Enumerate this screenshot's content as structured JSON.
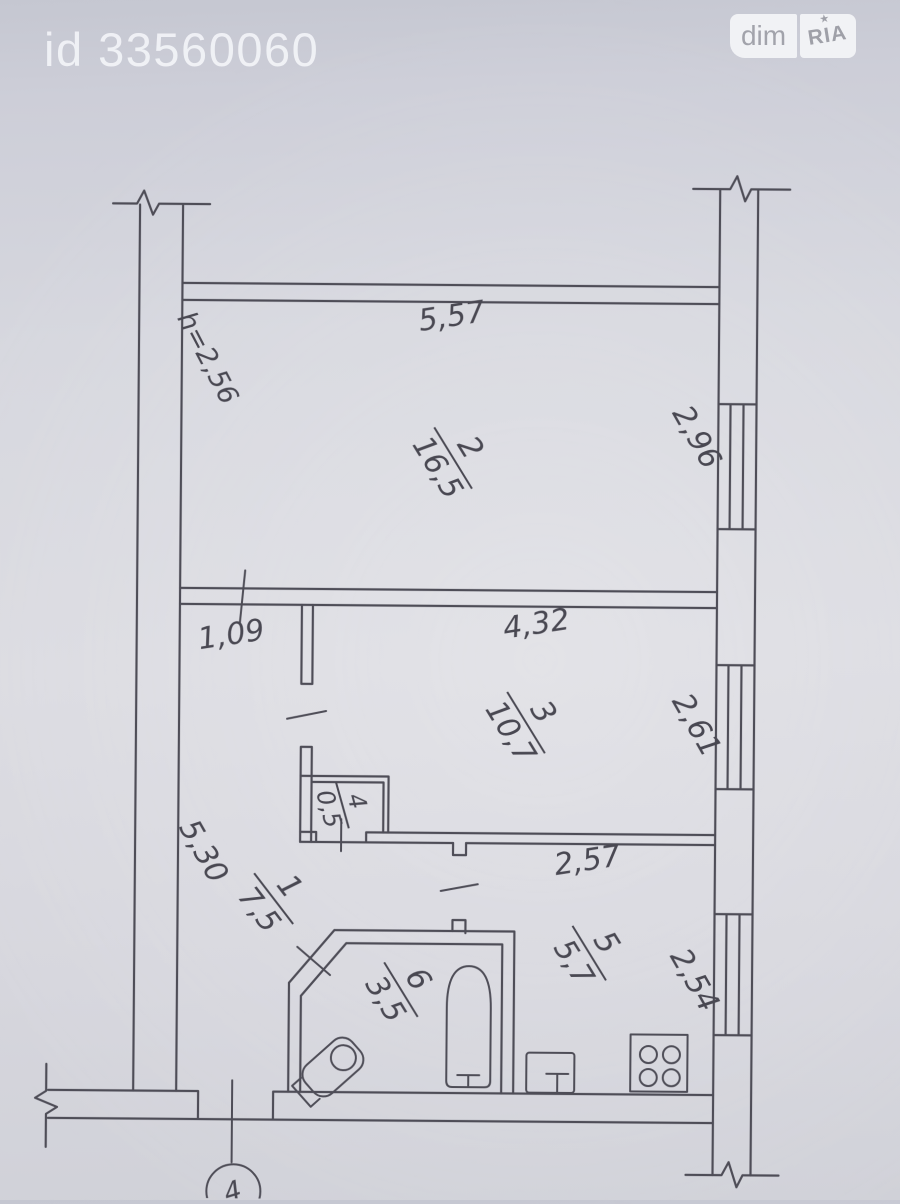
{
  "watermark": {
    "listing_id": "id 33560060"
  },
  "logo": {
    "dim": "dim",
    "ria": "RIA",
    "star": "★"
  },
  "colors": {
    "background": "#d7d8df",
    "ink": "#4e4d57",
    "watermark_text": "#f0f1f5",
    "logo_badge": "#f3f4f6",
    "logo_text": "#a3a4ac"
  },
  "plan": {
    "height_note": "h=2,56",
    "axis_label": "4",
    "dims": {
      "room2_width": "5,57",
      "room2_depth": "2,96",
      "hall_offset": "1,09",
      "room3_width": "4,32",
      "room3_depth": "2,61",
      "hall_depth": "5,30",
      "kitchen_width": "2,57",
      "kitchen_depth": "2,54"
    },
    "rooms": {
      "r1": {
        "number": "1",
        "area": "7,5"
      },
      "r2": {
        "number": "2",
        "area": "16,5"
      },
      "r3": {
        "number": "3",
        "area": "10,7"
      },
      "r4": {
        "number": "4",
        "area": "0,5"
      },
      "r5": {
        "number": "5",
        "area": "5,7"
      },
      "r6": {
        "number": "6",
        "area": "3,5"
      }
    }
  }
}
